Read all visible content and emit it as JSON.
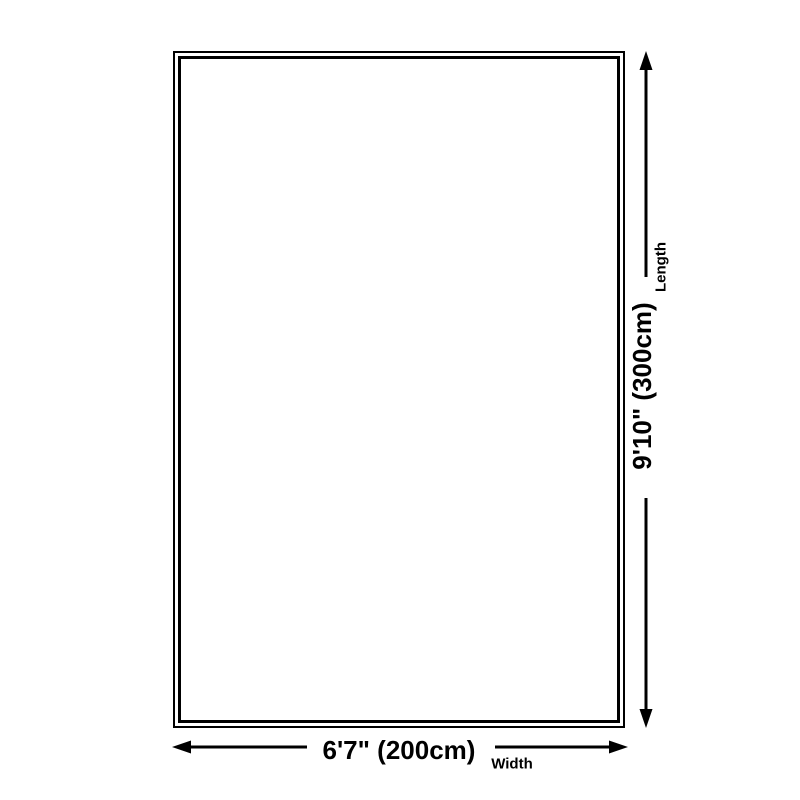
{
  "diagram": {
    "length": {
      "value": "9'10\" (300cm)",
      "label": "Length"
    },
    "width": {
      "value": "6'7\" (200cm)",
      "label": "Width"
    },
    "colors": {
      "line": "#000000",
      "background": "#ffffff"
    }
  }
}
